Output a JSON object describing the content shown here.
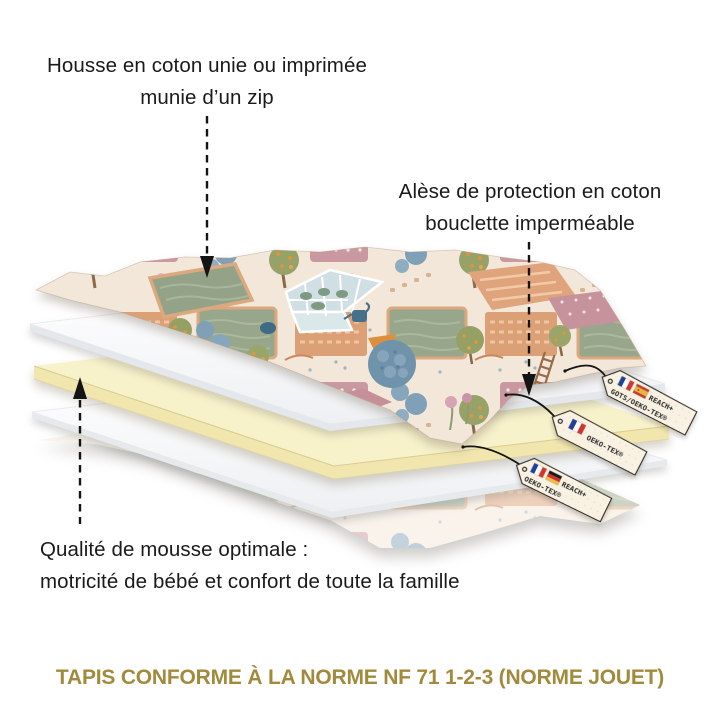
{
  "canvas": {
    "background": "#ffffff"
  },
  "annotations": {
    "housse": {
      "line1": "Housse en coton unie ou imprimée",
      "line2": "munie d’un zip"
    },
    "alese": {
      "line1": "Alèse de protection en coton",
      "line2": "bouclette imperméable"
    },
    "mousse": {
      "line1": "Qualité de mousse optimale :",
      "line2": "motricité de bébé et confort de toute la famille"
    }
  },
  "footer": {
    "title": "TAPIS CONFORME À LA NORME NF 71 1-2-3 (NORME JOUET)",
    "color": "#a28a3d"
  },
  "certification_tags": [
    {
      "flags": [
        "france-flag-icon",
        "spain-flag-icon"
      ],
      "line1": "REACH+",
      "line2": "GOTS/OEKO-TEX®"
    },
    {
      "flags": [
        "france-flag-icon"
      ],
      "line1": "OEKO-TEX®",
      "line2": ""
    },
    {
      "flags": [
        "france-flag-icon",
        "germany-flag-icon"
      ],
      "line1": "REACH+",
      "line2": "OEKO-TEX®"
    }
  ],
  "layers": [
    {
      "id": "housse-dessus",
      "color": "#f3e7d9"
    },
    {
      "id": "alese",
      "color": "#ffffff"
    },
    {
      "id": "mousse",
      "color": "#f8f2cb"
    },
    {
      "id": "doublure",
      "color": "#ffffff"
    },
    {
      "id": "housse-dessous",
      "color": "#f3e7d9"
    }
  ],
  "arrow_color": "#141414"
}
